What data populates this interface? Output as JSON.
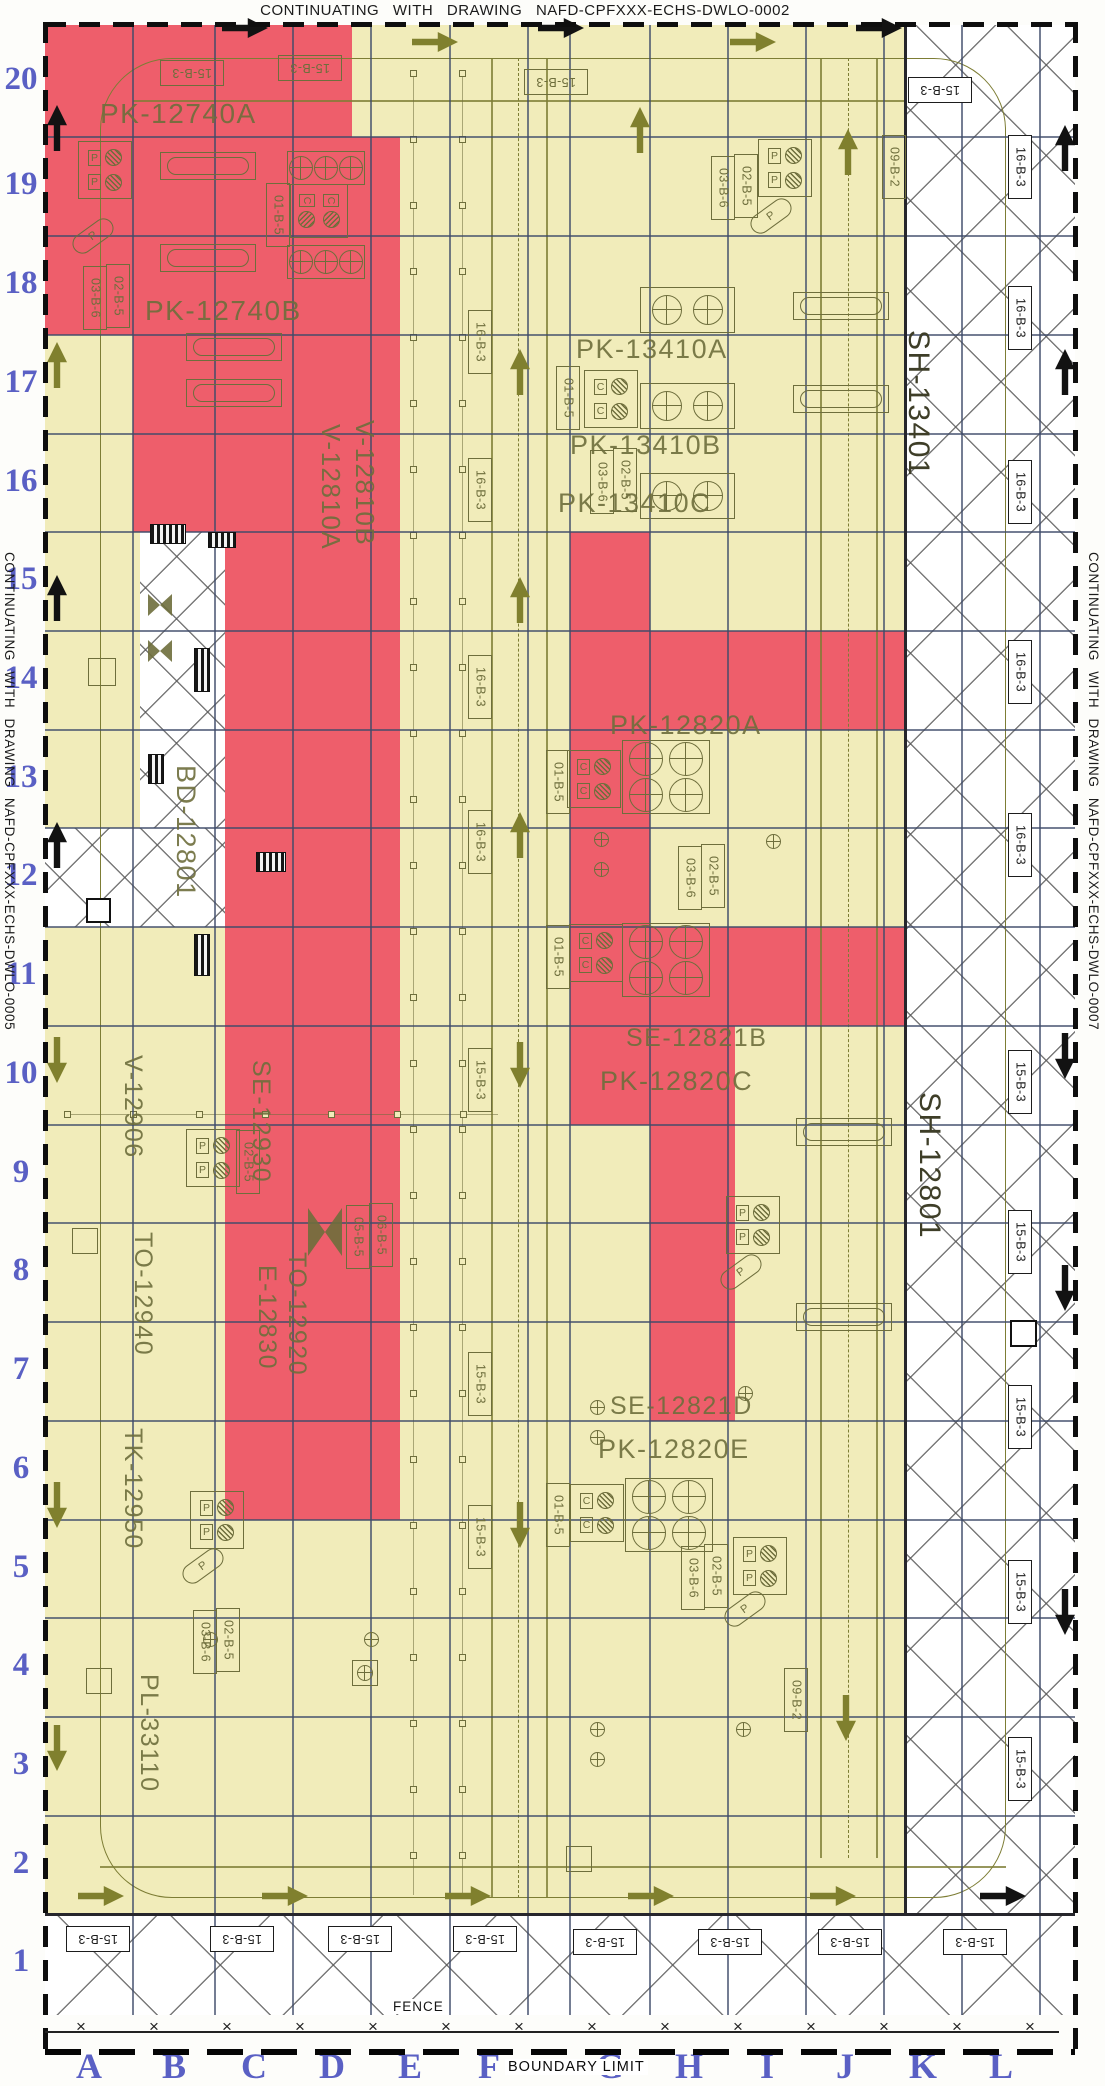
{
  "titles": {
    "top": "CONTINUATING WITH DRAWING NAFD-CPFXXX-ECHS-DWLO-0002",
    "left": "CONTINUATING WITH DRAWING NAFD-CPFXXX-ECHS-DWLO-0005",
    "right": "CONTINUATING WITH DRAWING NAFD-CPFXXX-ECHS-DWLO-0007",
    "fence": "FENCE",
    "boundary": "BOUNDARY LIMIT"
  },
  "colors": {
    "yellow": "#f1ecba",
    "red": "#ee5e6b",
    "olive": "#6e6e3c",
    "road": "#7d7d35",
    "grid_blue": "#3e4b69",
    "label_blue": "#5a60c4",
    "black": "#121212",
    "white": "#ffffff"
  },
  "grid": {
    "rows": [
      {
        "n": "20",
        "y": 81
      },
      {
        "n": "19",
        "y": 186
      },
      {
        "n": "18",
        "y": 285
      },
      {
        "n": "17",
        "y": 384
      },
      {
        "n": "16",
        "y": 483
      },
      {
        "n": "15",
        "y": 581
      },
      {
        "n": "14",
        "y": 680
      },
      {
        "n": "13",
        "y": 779
      },
      {
        "n": "12",
        "y": 877
      },
      {
        "n": "11",
        "y": 976
      },
      {
        "n": "10",
        "y": 1075
      },
      {
        "n": "9",
        "y": 1174
      },
      {
        "n": "8",
        "y": 1272
      },
      {
        "n": "7",
        "y": 1371
      },
      {
        "n": "6",
        "y": 1470
      },
      {
        "n": "5",
        "y": 1569
      },
      {
        "n": "4",
        "y": 1667
      },
      {
        "n": "3",
        "y": 1766
      },
      {
        "n": "2",
        "y": 1865
      },
      {
        "n": "1",
        "y": 1963
      }
    ],
    "cols": [
      {
        "n": "A",
        "x": 89
      },
      {
        "n": "B",
        "x": 174
      },
      {
        "n": "C",
        "x": 254
      },
      {
        "n": "D",
        "x": 332
      },
      {
        "n": "E",
        "x": 410
      },
      {
        "n": "F",
        "x": 489
      },
      {
        "n": "G",
        "x": 610
      },
      {
        "n": "H",
        "x": 689
      },
      {
        "n": "I",
        "x": 767
      },
      {
        "n": "J",
        "x": 845
      },
      {
        "n": "K",
        "x": 923
      },
      {
        "n": "L",
        "x": 1001
      }
    ],
    "vlines": [
      133,
      215,
      293,
      371,
      450,
      528,
      570,
      650,
      728,
      806,
      884,
      962,
      1040
    ],
    "hlines": [
      137,
      236,
      335,
      434,
      532,
      631,
      730,
      828,
      927,
      1026,
      1125,
      1223,
      1322,
      1421,
      1520,
      1618,
      1717,
      1816
    ]
  },
  "zones": {
    "base": [
      45,
      25,
      1075,
      1915
    ],
    "red": [
      [
        45,
        25,
        352,
        137
      ],
      [
        45,
        137,
        400,
        335
      ],
      [
        133,
        335,
        400,
        532
      ],
      [
        225,
        532,
        400,
        1520
      ],
      [
        570,
        532,
        650,
        1125
      ],
      [
        650,
        631,
        950,
        730
      ],
      [
        650,
        927,
        950,
        1026
      ],
      [
        650,
        1026,
        735,
        1421
      ]
    ],
    "white": [
      [
        906,
        25,
        1075,
        1915,
        64
      ],
      [
        45,
        1915,
        1075,
        2015,
        80
      ],
      [
        140,
        532,
        225,
        830,
        44
      ],
      [
        45,
        828,
        225,
        927,
        46
      ]
    ]
  },
  "roads": {
    "ring": [
      100,
      58,
      906,
      1840,
      72
    ],
    "edges": [
      [
        133,
        100,
        906,
        101.5
      ],
      [
        100,
        1866,
        1006,
        1867.5
      ],
      [
        491,
        58,
        492.5,
        1898
      ],
      [
        546,
        58,
        547.5,
        1898
      ],
      [
        820,
        58,
        821.5,
        1858
      ],
      [
        876,
        58,
        877.5,
        1858
      ]
    ],
    "centers": [
      [
        518,
        58,
        1898
      ],
      [
        848,
        58,
        1858
      ]
    ]
  },
  "equipment_labels": [
    {
      "text": "PK-12740A",
      "x": 100,
      "y": 100,
      "o": "h",
      "fs": 28
    },
    {
      "text": "PK-12740B",
      "x": 145,
      "y": 297,
      "o": "h",
      "fs": 28
    },
    {
      "text": "V-12810B",
      "x": 352,
      "y": 420,
      "o": "v",
      "fs": 26
    },
    {
      "text": "V-12810A",
      "x": 318,
      "y": 424,
      "o": "v",
      "fs": 26
    },
    {
      "text": "PK-13410A",
      "x": 576,
      "y": 336,
      "o": "h",
      "fs": 27
    },
    {
      "text": "PK-13410B",
      "x": 570,
      "y": 432,
      "o": "h",
      "fs": 27
    },
    {
      "text": "PK-13410C",
      "x": 558,
      "y": 490,
      "o": "h",
      "fs": 27
    },
    {
      "text": "PK-12820A",
      "x": 610,
      "y": 712,
      "o": "h",
      "fs": 27
    },
    {
      "text": "SE-12821B",
      "x": 626,
      "y": 1026,
      "o": "h",
      "fs": 25
    },
    {
      "text": "PK-12820C",
      "x": 600,
      "y": 1068,
      "o": "h",
      "fs": 27
    },
    {
      "text": "SE-12821D",
      "x": 610,
      "y": 1394,
      "o": "h",
      "fs": 25
    },
    {
      "text": "PK-12820E",
      "x": 598,
      "y": 1436,
      "o": "h",
      "fs": 27
    },
    {
      "text": "BD-12801",
      "x": 172,
      "y": 765,
      "o": "v",
      "fs": 27
    },
    {
      "text": "SH-13401",
      "x": 903,
      "y": 330,
      "o": "v",
      "fs": 30,
      "dark": true
    },
    {
      "text": "SH-12801",
      "x": 914,
      "y": 1092,
      "o": "v",
      "fs": 30,
      "dark": true
    },
    {
      "text": "V-12906",
      "x": 120,
      "y": 1055,
      "o": "v",
      "fs": 25
    },
    {
      "text": "SE-12930",
      "x": 248,
      "y": 1060,
      "o": "v",
      "fs": 25
    },
    {
      "text": "TO-12940",
      "x": 130,
      "y": 1232,
      "o": "v",
      "fs": 25
    },
    {
      "text": "TO-12920",
      "x": 284,
      "y": 1252,
      "o": "v",
      "fs": 25
    },
    {
      "text": "E-12830",
      "x": 254,
      "y": 1265,
      "o": "v",
      "fs": 25
    },
    {
      "text": "TK-12950",
      "x": 120,
      "y": 1428,
      "o": "v",
      "fs": 25
    },
    {
      "text": "PL-33110",
      "x": 136,
      "y": 1674,
      "o": "v",
      "fs": 25
    }
  ],
  "tag_boxes": [
    {
      "t": "15-B-3",
      "x": 160,
      "y": 60,
      "o": "u",
      "th": "y"
    },
    {
      "t": "15-B-3",
      "x": 278,
      "y": 55,
      "o": "u",
      "th": "y"
    },
    {
      "t": "15-B-3",
      "x": 524,
      "y": 69,
      "o": "u",
      "th": "y"
    },
    {
      "t": "15-B-3",
      "x": 908,
      "y": 77,
      "o": "u",
      "th": "w"
    },
    {
      "t": "16-B-3",
      "x": 1008,
      "y": 135,
      "o": "v",
      "th": "w"
    },
    {
      "t": "16-B-3",
      "x": 1008,
      "y": 286,
      "o": "v",
      "th": "w"
    },
    {
      "t": "16-B-3",
      "x": 1008,
      "y": 460,
      "o": "v",
      "th": "w"
    },
    {
      "t": "16-B-3",
      "x": 1008,
      "y": 640,
      "o": "v",
      "th": "w"
    },
    {
      "t": "16-B-3",
      "x": 1008,
      "y": 813,
      "o": "v",
      "th": "w"
    },
    {
      "t": "15-B-3",
      "x": 1008,
      "y": 1050,
      "o": "v",
      "th": "w"
    },
    {
      "t": "15-B-3",
      "x": 1008,
      "y": 1210,
      "o": "v",
      "th": "w"
    },
    {
      "t": "15-B-3",
      "x": 1008,
      "y": 1385,
      "o": "v",
      "th": "w"
    },
    {
      "t": "15-B-3",
      "x": 1008,
      "y": 1560,
      "o": "v",
      "th": "w"
    },
    {
      "t": "15-B-3",
      "x": 1008,
      "y": 1737,
      "o": "v",
      "th": "w"
    },
    {
      "t": "16-B-3",
      "x": 468,
      "y": 310,
      "o": "v",
      "th": "y"
    },
    {
      "t": "16-B-3",
      "x": 468,
      "y": 458,
      "o": "v",
      "th": "y"
    },
    {
      "t": "16-B-3",
      "x": 468,
      "y": 655,
      "o": "v",
      "th": "y"
    },
    {
      "t": "16-B-3",
      "x": 468,
      "y": 810,
      "o": "v",
      "th": "y"
    },
    {
      "t": "15-B-3",
      "x": 468,
      "y": 1048,
      "o": "v",
      "th": "y"
    },
    {
      "t": "15-B-3",
      "x": 468,
      "y": 1352,
      "o": "v",
      "th": "y"
    },
    {
      "t": "15-B-3",
      "x": 468,
      "y": 1505,
      "o": "v",
      "th": "y"
    },
    {
      "t": "01-B-5",
      "x": 266,
      "y": 183,
      "o": "v",
      "th": "y"
    },
    {
      "t": "01-B-5",
      "x": 556,
      "y": 366,
      "o": "v",
      "th": "y"
    },
    {
      "t": "01-B-5",
      "x": 546,
      "y": 750,
      "o": "v",
      "th": "y"
    },
    {
      "t": "01-B-5",
      "x": 546,
      "y": 925,
      "o": "v",
      "th": "y"
    },
    {
      "t": "01-B-5",
      "x": 546,
      "y": 1483,
      "o": "v",
      "th": "y"
    },
    {
      "t": "03-B-6",
      "x": 83,
      "y": 266,
      "o": "v",
      "th": "y"
    },
    {
      "t": "02-B-5",
      "x": 106,
      "y": 264,
      "o": "v",
      "th": "y"
    },
    {
      "t": "03-B-6",
      "x": 711,
      "y": 156,
      "o": "v",
      "th": "y"
    },
    {
      "t": "02-B-5",
      "x": 734,
      "y": 154,
      "o": "v",
      "th": "y"
    },
    {
      "t": "03-B-6",
      "x": 590,
      "y": 450,
      "o": "v",
      "th": "y"
    },
    {
      "t": "02-B-5",
      "x": 613,
      "y": 448,
      "o": "v",
      "th": "y"
    },
    {
      "t": "03-B-6",
      "x": 678,
      "y": 846,
      "o": "v",
      "th": "y"
    },
    {
      "t": "02-B-5",
      "x": 701,
      "y": 844,
      "o": "v",
      "th": "y"
    },
    {
      "t": "03-B-6",
      "x": 681,
      "y": 1546,
      "o": "v",
      "th": "y"
    },
    {
      "t": "02-B-5",
      "x": 704,
      "y": 1544,
      "o": "v",
      "th": "y"
    },
    {
      "t": "03-B-6",
      "x": 193,
      "y": 1610,
      "o": "v",
      "th": "y"
    },
    {
      "t": "02-B-5",
      "x": 216,
      "y": 1608,
      "o": "v",
      "th": "y"
    },
    {
      "t": "02-B-5",
      "x": 236,
      "y": 1130,
      "o": "v",
      "th": "y"
    },
    {
      "t": "05-B-5",
      "x": 346,
      "y": 1205,
      "o": "v",
      "th": "y"
    },
    {
      "t": "06-B-5",
      "x": 369,
      "y": 1203,
      "o": "v",
      "th": "y"
    },
    {
      "t": "09-B-2",
      "x": 882,
      "y": 135,
      "o": "v",
      "th": "y"
    },
    {
      "t": "09-B-2",
      "x": 784,
      "y": 1668,
      "o": "v",
      "th": "y"
    },
    {
      "t": "15-B-3",
      "x": 66,
      "y": 1926,
      "o": "u",
      "th": "w"
    },
    {
      "t": "15-B-3",
      "x": 210,
      "y": 1926,
      "o": "u",
      "th": "w"
    },
    {
      "t": "15-B-3",
      "x": 328,
      "y": 1926,
      "o": "u",
      "th": "w"
    },
    {
      "t": "15-B-3",
      "x": 453,
      "y": 1926,
      "o": "u",
      "th": "w"
    },
    {
      "t": "15-B-3",
      "x": 573,
      "y": 1929,
      "o": "u",
      "th": "w"
    },
    {
      "t": "15-B-3",
      "x": 698,
      "y": 1929,
      "o": "u",
      "th": "w"
    },
    {
      "t": "15-B-3",
      "x": 818,
      "y": 1929,
      "o": "u",
      "th": "w"
    },
    {
      "t": "15-B-3",
      "x": 943,
      "y": 1929,
      "o": "u",
      "th": "w"
    }
  ],
  "arrows": [
    [
      222,
      18,
      "right",
      "k"
    ],
    [
      538,
      18,
      "right",
      "k"
    ],
    [
      856,
      18,
      "right",
      "k"
    ],
    [
      412,
      32,
      "right",
      "o"
    ],
    [
      730,
      32,
      "right",
      "o"
    ],
    [
      617,
      120,
      "up",
      "o"
    ],
    [
      34,
      118,
      "up",
      "k"
    ],
    [
      34,
      355,
      "up",
      "o"
    ],
    [
      34,
      588,
      "up",
      "k"
    ],
    [
      34,
      835,
      "up",
      "k"
    ],
    [
      34,
      1050,
      "down",
      "o"
    ],
    [
      34,
      1495,
      "down",
      "o"
    ],
    [
      34,
      1738,
      "down",
      "o"
    ],
    [
      1042,
      138,
      "up",
      "k"
    ],
    [
      1042,
      362,
      "up",
      "k"
    ],
    [
      1042,
      1046,
      "down",
      "k"
    ],
    [
      1042,
      1278,
      "down",
      "k"
    ],
    [
      1042,
      1602,
      "down",
      "k"
    ],
    [
      497,
      362,
      "up",
      "o"
    ],
    [
      497,
      590,
      "up",
      "o"
    ],
    [
      497,
      825,
      "up",
      "o"
    ],
    [
      497,
      1055,
      "down",
      "o"
    ],
    [
      497,
      1515,
      "down",
      "o"
    ],
    [
      825,
      142,
      "up",
      "o"
    ],
    [
      823,
      1708,
      "down",
      "o"
    ],
    [
      78,
      1886,
      "right",
      "o"
    ],
    [
      262,
      1886,
      "right",
      "o"
    ],
    [
      445,
      1886,
      "right",
      "o"
    ],
    [
      628,
      1886,
      "right",
      "o"
    ],
    [
      810,
      1886,
      "right",
      "o"
    ],
    [
      980,
      1886,
      "right",
      "k"
    ]
  ],
  "symbols": {
    "pump_pairs": {
      "pos": [
        [
          640,
          287
        ],
        [
          640,
          383
        ],
        [
          640,
          473
        ]
      ],
      "w": 95,
      "h": 46,
      "d": 30,
      "n": 2
    },
    "pump_quads": {
      "pos": [
        [
          622,
          740
        ],
        [
          622,
          923
        ],
        [
          625,
          1478
        ]
      ],
      "w": 88,
      "h": 74,
      "d": 34,
      "n": 4
    },
    "pump_triples": {
      "pos": [
        [
          287,
          151
        ],
        [
          287,
          245
        ]
      ],
      "w": 78,
      "h": 34,
      "d": 24,
      "n": 3
    },
    "c_boxes": [
      [
        584,
        370,
        0
      ],
      [
        567,
        750,
        0
      ],
      [
        569,
        924,
        0
      ],
      [
        570,
        1484,
        0
      ],
      [
        292,
        182,
        1
      ]
    ],
    "p_boxes": [
      [
        78,
        141,
        0
      ],
      [
        758,
        139,
        0
      ],
      [
        726,
        1196,
        0
      ],
      [
        186,
        1129,
        0
      ],
      [
        190,
        1491,
        0
      ],
      [
        733,
        1537,
        0
      ]
    ],
    "p_diag": [
      [
        70,
        226
      ],
      [
        748,
        206
      ],
      [
        718,
        1262
      ],
      [
        180,
        1556
      ],
      [
        722,
        1599
      ]
    ],
    "c_letter": "C",
    "p_letter": "P",
    "vessels": [
      [
        160,
        152
      ],
      [
        160,
        244
      ],
      [
        186,
        333
      ],
      [
        186,
        379
      ],
      [
        793,
        292
      ],
      [
        793,
        385
      ],
      [
        796,
        1118
      ],
      [
        796,
        1303
      ]
    ],
    "plain_squares": [
      [
        88,
        658,
        28
      ],
      [
        72,
        1228,
        26
      ],
      [
        86,
        1668,
        26
      ],
      [
        566,
        1846,
        26
      ]
    ],
    "border_squares": [
      [
        1010,
        1320,
        27
      ],
      [
        86,
        898,
        25
      ]
    ],
    "bowties": [
      [
        148,
        594,
        24,
        22
      ],
      [
        148,
        640,
        24,
        22
      ],
      [
        308,
        1208,
        34,
        48
      ]
    ],
    "stairs": [
      [
        150,
        524,
        36,
        20
      ],
      [
        208,
        532,
        28,
        16
      ],
      [
        194,
        648,
        16,
        44
      ],
      [
        148,
        754,
        16,
        30
      ],
      [
        256,
        852,
        30,
        20
      ],
      [
        194,
        934,
        16,
        42
      ]
    ],
    "cross_marks": [
      [
        594,
        832
      ],
      [
        594,
        862
      ],
      [
        766,
        834
      ],
      [
        590,
        1400
      ],
      [
        738,
        1386
      ],
      [
        590,
        1430
      ],
      [
        590,
        1722
      ],
      [
        736,
        1722
      ],
      [
        590,
        1752
      ],
      [
        364,
        1632
      ],
      [
        203,
        1632
      ]
    ],
    "sq_circle": [
      [
        352,
        1660
      ]
    ],
    "rack_cols": [
      413,
      462
    ],
    "rack_y": [
      70,
      1895
    ],
    "rack_step": 66,
    "rack_row": {
      "y": 1114,
      "x1": 64,
      "x2": 498,
      "step": 66
    }
  },
  "fence": {
    "line_y": 2031,
    "x0": 84,
    "step": 73,
    "count": 14,
    "glyph": "×"
  },
  "frame": {
    "top": [
      45,
      22,
      1030,
      5
    ],
    "left": [
      43,
      22,
      5,
      2030
    ],
    "right": [
      1073,
      22,
      5,
      2030
    ],
    "boundary": [
      45,
      2049,
      1030,
      6
    ],
    "strip_v": [
      904,
      25,
      2.5,
      1890
    ],
    "strip_h": [
      45,
      1913,
      1030,
      2.5
    ]
  }
}
